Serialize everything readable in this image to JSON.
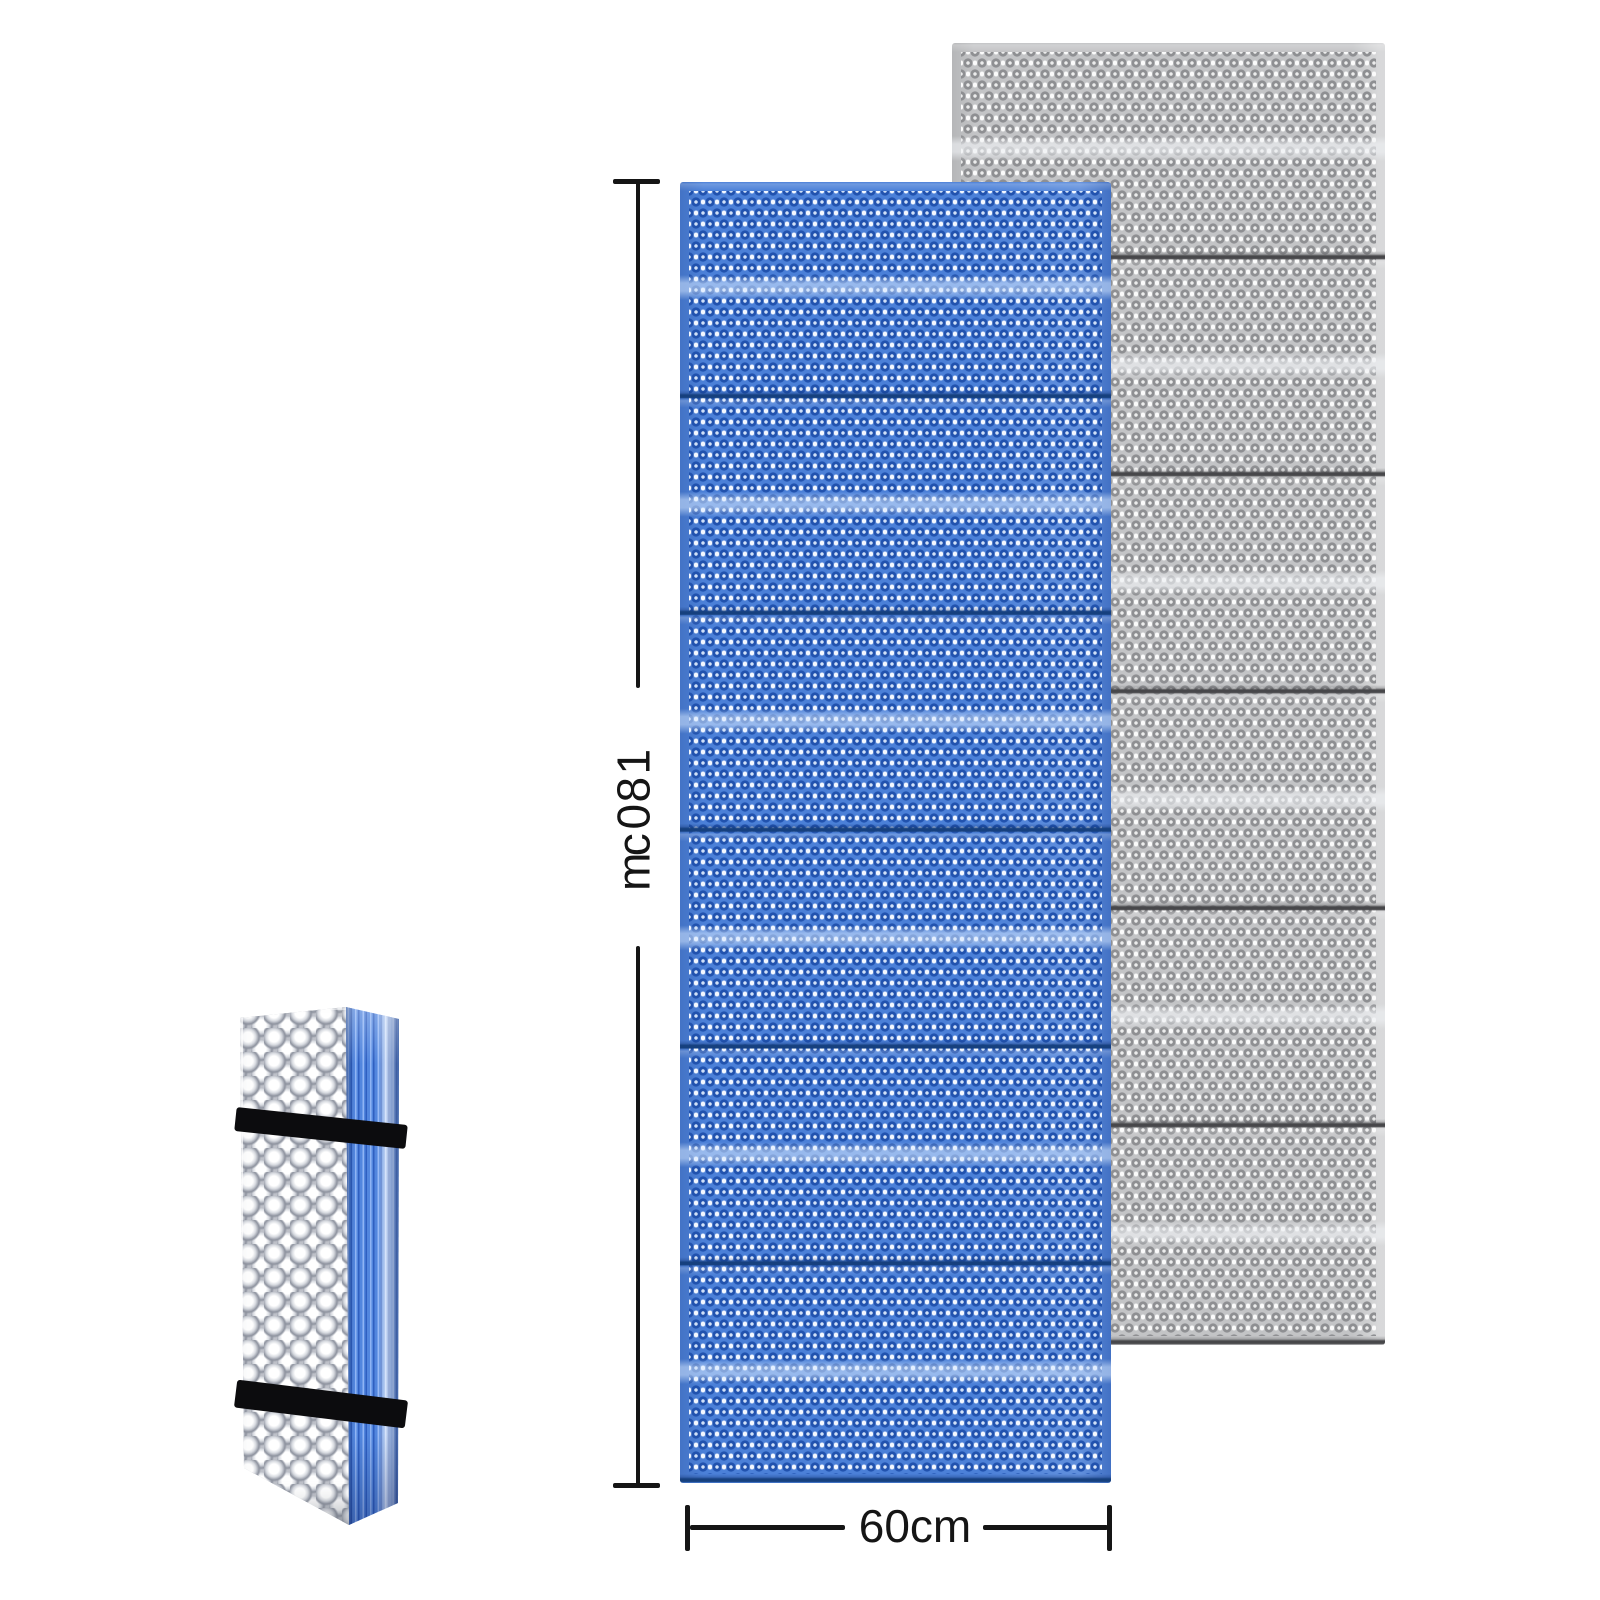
{
  "annotations": {
    "height_label": "180cm",
    "width_label": "60cm"
  },
  "product": {
    "unfolded_mats": [
      {
        "color_name": "blue",
        "fold_sections": 12,
        "fold_seams": 5
      },
      {
        "color_name": "gray",
        "fold_sections": 12,
        "fold_seams": 5
      }
    ],
    "folded_mat": {
      "straps": 2,
      "front_texture": "egg-crate-bumps",
      "side_texture": "folded-layer-stripes"
    }
  },
  "colors": {
    "background": "#ffffff",
    "dim-line": "#151515",
    "blue-base": "#4b80d8",
    "blue-core": "#cfe0f8",
    "blue-ring": "#2152ae",
    "blue-dot": "#f4f8ff",
    "blue-seam": "#16407e",
    "gray-base": "#c3c4c6",
    "gray-core": "#ececec",
    "gray-ring": "#8e8f92",
    "gray-dot": "#fbfbfb",
    "gray-seam": "#47474a",
    "fold-front": "#bdc0c8",
    "fold-bump-hi": "#ffffff",
    "fold-bump-sh": "#8e939f",
    "fold-side": "#5286de",
    "fold-side-dark": "#2f5fc0",
    "fold-side-light": "#8fb4f4",
    "strap": "#0c0c0e"
  }
}
